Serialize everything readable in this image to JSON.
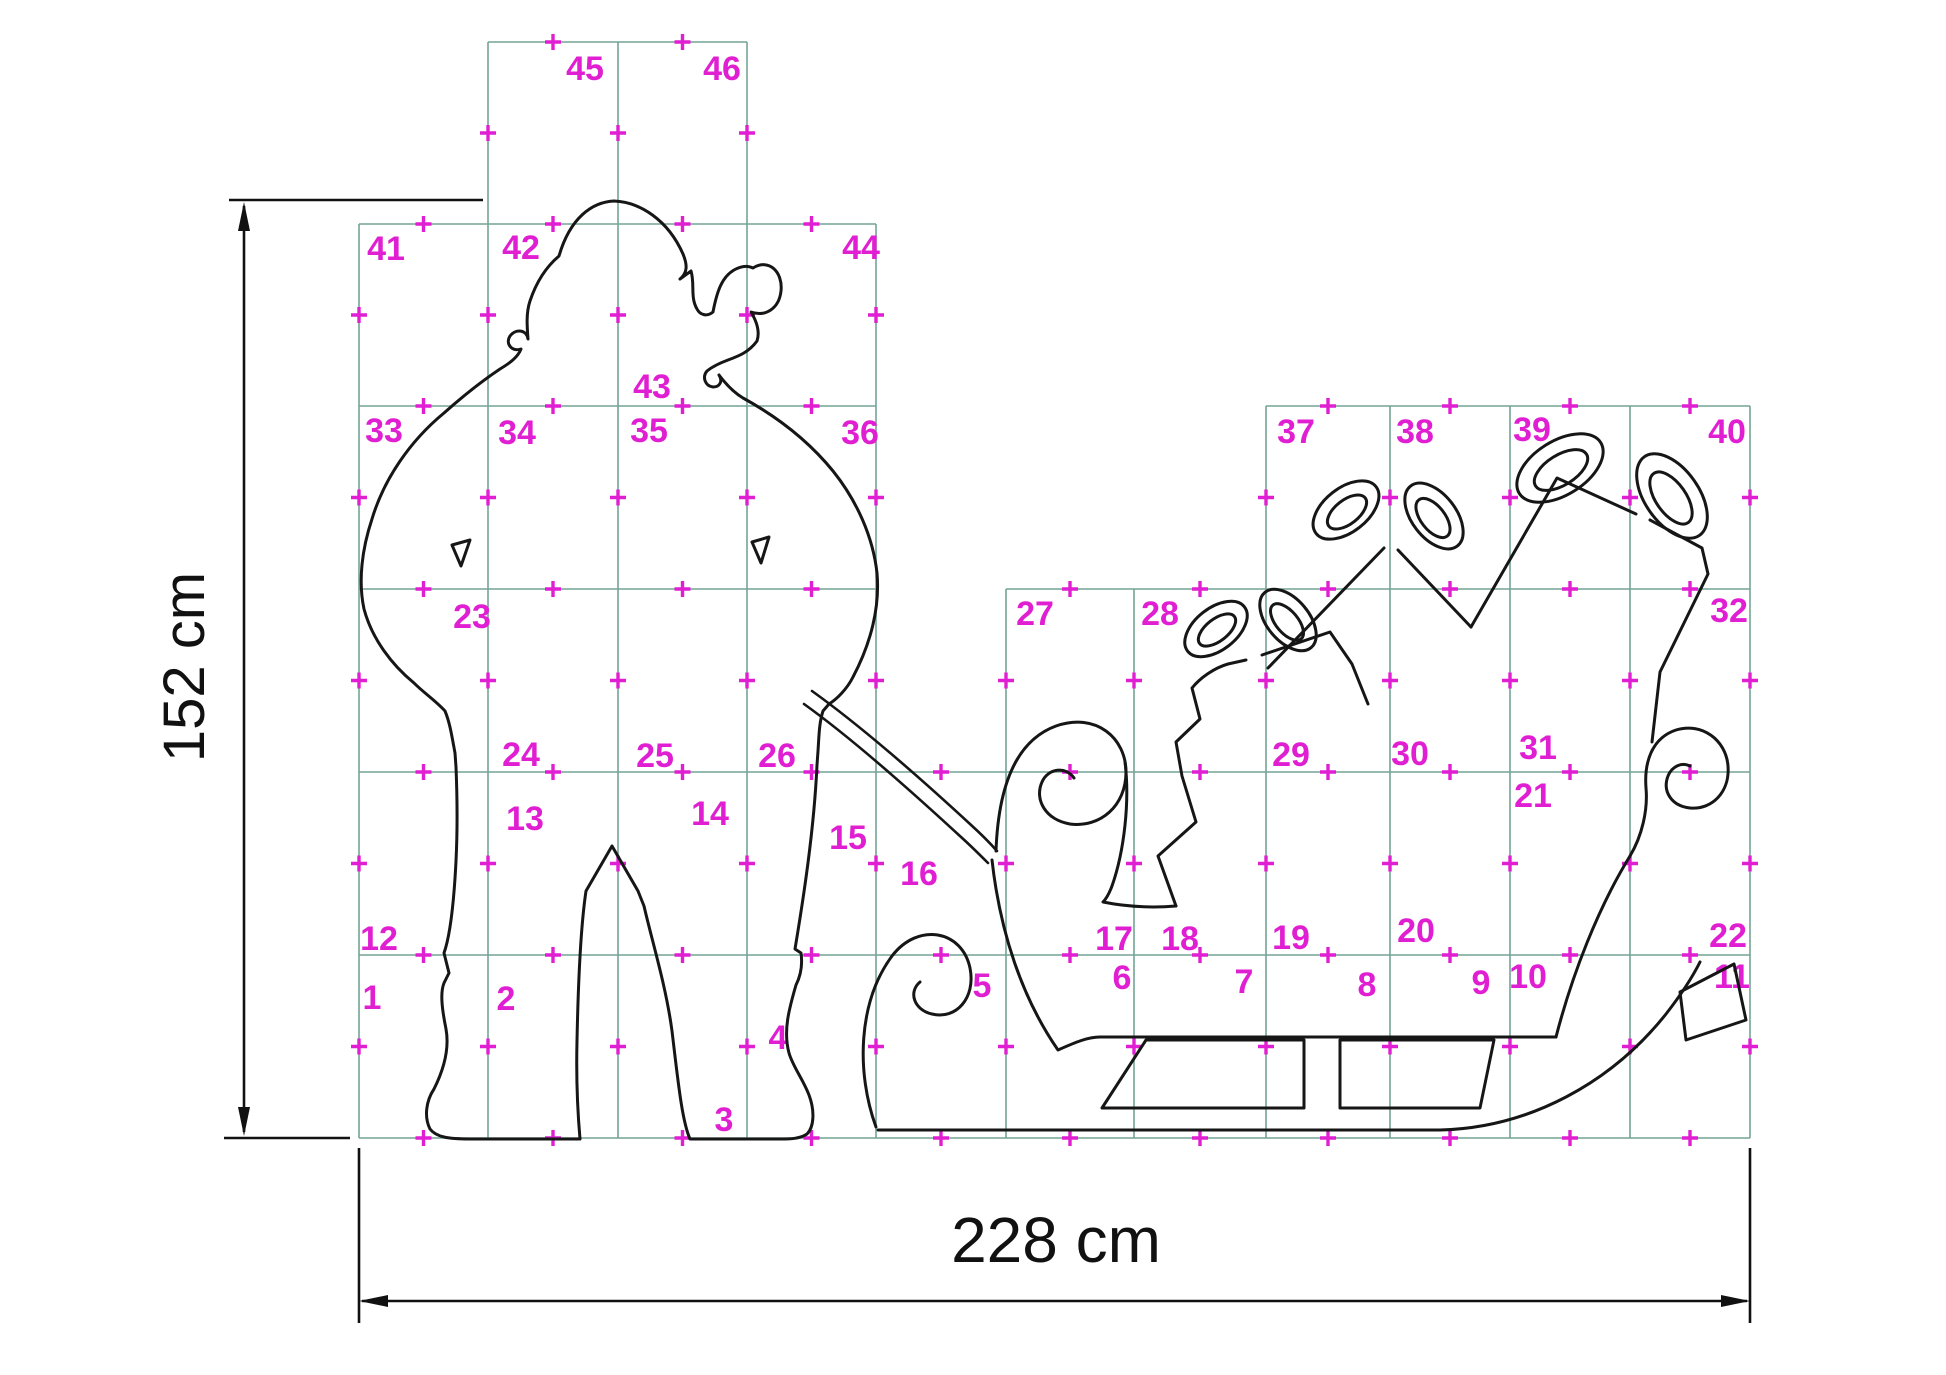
{
  "meta": {
    "description": "Full-size cutting pattern grid sheet: Santa Claus pulling a sleigh loaded with gift boxes, split into numbered tile pages with alignment cross marks and overall dimensions."
  },
  "colors": {
    "background": "#ffffff",
    "grid": "#74a396",
    "mark": "#e01fd2",
    "outline": "#161616",
    "dimension": "#111111"
  },
  "grid": {
    "row_lines": [
      42,
      224,
      406,
      589,
      772,
      955,
      1138
    ],
    "col_lines": [
      359,
      488,
      618,
      747,
      876,
      1006,
      1134,
      1266,
      1390,
      1510,
      1630,
      1750
    ],
    "h_segments": [
      {
        "y": 42,
        "x1": 488,
        "x2": 747
      },
      {
        "y": 224,
        "x1": 359,
        "x2": 876
      },
      {
        "y": 406,
        "x1": 359,
        "x2": 876
      },
      {
        "y": 406,
        "x1": 1266,
        "x2": 1750
      },
      {
        "y": 589,
        "x1": 359,
        "x2": 876
      },
      {
        "y": 589,
        "x1": 1006,
        "x2": 1750
      },
      {
        "y": 772,
        "x1": 359,
        "x2": 1750
      },
      {
        "y": 955,
        "x1": 359,
        "x2": 1750
      },
      {
        "y": 1138,
        "x1": 359,
        "x2": 1750
      }
    ],
    "v_segments": [
      {
        "x": 359,
        "y1": 224,
        "y2": 1138
      },
      {
        "x": 488,
        "y1": 42,
        "y2": 1138
      },
      {
        "x": 618,
        "y1": 42,
        "y2": 1138
      },
      {
        "x": 747,
        "y1": 42,
        "y2": 1138
      },
      {
        "x": 876,
        "y1": 224,
        "y2": 1138
      },
      {
        "x": 1006,
        "y1": 589,
        "y2": 1138
      },
      {
        "x": 1134,
        "y1": 589,
        "y2": 1138
      },
      {
        "x": 1266,
        "y1": 406,
        "y2": 1138
      },
      {
        "x": 1390,
        "y1": 406,
        "y2": 1138
      },
      {
        "x": 1510,
        "y1": 406,
        "y2": 1138
      },
      {
        "x": 1630,
        "y1": 406,
        "y2": 1138
      },
      {
        "x": 1750,
        "y1": 406,
        "y2": 1138
      }
    ],
    "cross_arm": 8
  },
  "cells": [
    {
      "n": "1",
      "x": 372,
      "y": 998
    },
    {
      "n": "2",
      "x": 506,
      "y": 999
    },
    {
      "n": "3",
      "x": 724,
      "y": 1120
    },
    {
      "n": "4",
      "x": 778,
      "y": 1038
    },
    {
      "n": "5",
      "x": 982,
      "y": 986
    },
    {
      "n": "6",
      "x": 1122,
      "y": 978
    },
    {
      "n": "7",
      "x": 1244,
      "y": 982
    },
    {
      "n": "8",
      "x": 1367,
      "y": 985
    },
    {
      "n": "9",
      "x": 1481,
      "y": 983
    },
    {
      "n": "10",
      "x": 1528,
      "y": 977
    },
    {
      "n": "11",
      "x": 1732,
      "y": 977
    },
    {
      "n": "12",
      "x": 379,
      "y": 939
    },
    {
      "n": "13",
      "x": 525,
      "y": 819
    },
    {
      "n": "14",
      "x": 710,
      "y": 814
    },
    {
      "n": "15",
      "x": 848,
      "y": 838
    },
    {
      "n": "16",
      "x": 919,
      "y": 874
    },
    {
      "n": "17",
      "x": 1114,
      "y": 939
    },
    {
      "n": "18",
      "x": 1180,
      "y": 939
    },
    {
      "n": "19",
      "x": 1291,
      "y": 938
    },
    {
      "n": "20",
      "x": 1416,
      "y": 931
    },
    {
      "n": "21",
      "x": 1533,
      "y": 796
    },
    {
      "n": "22",
      "x": 1728,
      "y": 936
    },
    {
      "n": "23",
      "x": 472,
      "y": 617
    },
    {
      "n": "24",
      "x": 521,
      "y": 755
    },
    {
      "n": "25",
      "x": 655,
      "y": 756
    },
    {
      "n": "26",
      "x": 777,
      "y": 756
    },
    {
      "n": "27",
      "x": 1035,
      "y": 614
    },
    {
      "n": "28",
      "x": 1160,
      "y": 614
    },
    {
      "n": "29",
      "x": 1291,
      "y": 755
    },
    {
      "n": "30",
      "x": 1410,
      "y": 754
    },
    {
      "n": "31",
      "x": 1538,
      "y": 748
    },
    {
      "n": "32",
      "x": 1729,
      "y": 611
    },
    {
      "n": "33",
      "x": 384,
      "y": 431
    },
    {
      "n": "34",
      "x": 517,
      "y": 433
    },
    {
      "n": "35",
      "x": 649,
      "y": 431
    },
    {
      "n": "36",
      "x": 860,
      "y": 433
    },
    {
      "n": "37",
      "x": 1296,
      "y": 432
    },
    {
      "n": "38",
      "x": 1415,
      "y": 432
    },
    {
      "n": "39",
      "x": 1532,
      "y": 430
    },
    {
      "n": "40",
      "x": 1727,
      "y": 432
    },
    {
      "n": "41",
      "x": 386,
      "y": 249
    },
    {
      "n": "42",
      "x": 521,
      "y": 248
    },
    {
      "n": "43",
      "x": 652,
      "y": 387
    },
    {
      "n": "44",
      "x": 861,
      "y": 248
    },
    {
      "n": "45",
      "x": 585,
      "y": 69
    },
    {
      "n": "46",
      "x": 722,
      "y": 69
    }
  ],
  "cell_number_font_size": 34,
  "figure": {
    "santa": {
      "body": "M 559 256 C 570 218 592 202 614 201 C 640 202 668 220 683 254 C 688 266 687 273 680 279 L 691 271 C 695 284 690 297 697 309 C 700 315 707 317 713 312 C 717 291 722 277 734 270 C 741 266 747 265 753 268 C 769 258 783 272 781 291 C 779 309 765 317 751 312 C 757 322 760 332 757 341 C 749 352 739 356 728 360 C 720 363 713 366 707 371 C 702 377 705 386 713 387 C 720 387 723 381 719 375 C 725 383 733 392 743 398 C 774 415 807 439 833 471 C 857 501 873 537 877 573 C 880 607 871 643 853 677 C 847 689 837 699 829 704 L 823 711 C 819 723 819 737 818 751 L 817 765 C 814 831 803 901 795 949 L 801 953 C 803 967 800 977 796 985 C 789 1009 783 1031 789 1053 C 793 1067 803 1079 809 1095 C 815 1111 814 1127 807 1134 C 801 1138 793 1139 785 1139 L 690 1139 C 682 1121 678 1081 672 1031 C 666 986 652 941 644 906 L 638 891 L 612 846 L 586 891 C 580 931 578 991 577 1041 C 576 1081 578 1116 580 1139 L 470 1139 C 448 1139 436 1137 430 1129 C 424 1117 426 1101 434 1089 C 442 1073 450 1051 446 1029 C 442 1009 440 993 444 983 L 449 973 L 444 953 C 450 936 454 901 456 861 C 458 821 457 791 456 767 L 455 753 C 452 737 450 723 445 711 C 436 701 424 693 414 683 C 392 665 372 639 364 609 C 358 581 362 549 372 519 C 384 479 410 441 444 413 C 462 397 482 381 500 369 C 510 363 518 357 521 349 C 512 352 505 344 510 336 C 516 328 527 330 528 339 C 527 326 526 313 530 301 C 536 283 546 267 559 256 Z",
      "arm_slits": "M 452 545 L 470 540 L 461 566 Z M 752 542 L 769 537 L 761 563 Z",
      "rope_a": "M 812 691 C 858 724 918 776 970 824 C 981 834 990 843 997 851",
      "rope_b": "M 804 704 C 850 737 909 789 961 837 C 971 846 980 855 988 863"
    },
    "sleigh": {
      "front_curl": "M 996 851 C 998 795 1012 742 1056 726 C 1096 712 1126 738 1126 772 C 1126 806 1100 828 1070 824 C 1046 820 1034 800 1042 782 C 1048 768 1066 766 1074 778",
      "neck_top": "M 1125 762 C 1130 802 1124 852 1112 886 C 1109 894 1106 899 1103 902 C 1128 907 1152 908 1176 906",
      "front_bottom": "M 992 860 C 1000 932 1022 998 1058 1050 C 1076 1042 1088 1037 1100 1037 L 1556 1037",
      "back": "M 1556 1037 C 1572 975 1598 908 1630 856 C 1642 836 1648 810 1646 788 C 1644 762 1652 738 1676 730 C 1702 722 1726 740 1728 766 C 1730 792 1712 810 1690 808 C 1672 806 1662 792 1668 776 C 1672 766 1682 762 1690 766",
      "strut_1": "M 1146 1040 L 1304 1040 L 1304 1108 L 1102 1108 Z",
      "strut_2": "M 1340 1040 L 1494 1040 L 1480 1108 L 1340 1108 Z",
      "runner_spiral": "M 876 1127 C 856 1072 858 1002 892 956 C 918 922 962 930 970 968 C 976 998 956 1020 932 1014 C 914 1010 908 992 920 982",
      "runner_rail": "M 878 1130 L 1440 1130 C 1530 1128 1612 1082 1666 1014 C 1680 996 1692 978 1700 962",
      "runner_tail": "M 1686 1040 L 1680 992 L 1734 964 L 1746 1020 Z"
    },
    "presents": {
      "staircase": "M 1176 906 L 1158 856 L 1196 822 L 1182 776 L 1176 742 L 1200 719 L 1192 688 C 1200 678 1214 668 1228 664 L 1246 660",
      "box_1": "M 1262 655 L 1330 632 L 1352 664 L 1368 704",
      "box_2": "M 1268 668 L 1384 548 M 1398 550 L 1471 627",
      "box_3": "M 1471 627 L 1557 478 L 1636 514 M 1650 520 L 1702 548 L 1708 574 L 1660 672 L 1652 742",
      "bow_loops": [
        {
          "cx": 1216,
          "cy": 629,
          "rx": 36,
          "ry": 21,
          "rot": -38
        },
        {
          "cx": 1217,
          "cy": 630,
          "rx": 22,
          "ry": 11,
          "rot": -38
        },
        {
          "cx": 1288,
          "cy": 620,
          "rx": 36,
          "ry": 21,
          "rot": 50
        },
        {
          "cx": 1287,
          "cy": 622,
          "rx": 22,
          "ry": 11,
          "rot": 50
        },
        {
          "cx": 1346,
          "cy": 510,
          "rx": 38,
          "ry": 22,
          "rot": -38
        },
        {
          "cx": 1347,
          "cy": 512,
          "rx": 23,
          "ry": 12,
          "rot": -38
        },
        {
          "cx": 1434,
          "cy": 516,
          "rx": 38,
          "ry": 22,
          "rot": 52
        },
        {
          "cx": 1433,
          "cy": 518,
          "rx": 23,
          "ry": 12,
          "rot": 52
        },
        {
          "cx": 1560,
          "cy": 468,
          "rx": 48,
          "ry": 27,
          "rot": -32
        },
        {
          "cx": 1561,
          "cy": 470,
          "rx": 30,
          "ry": 15,
          "rot": -32
        },
        {
          "cx": 1672,
          "cy": 496,
          "rx": 48,
          "ry": 27,
          "rot": 55
        },
        {
          "cx": 1671,
          "cy": 498,
          "rx": 30,
          "ry": 15,
          "rot": 55
        }
      ]
    }
  },
  "dimensions": {
    "vertical": {
      "label": "152 cm",
      "line": {
        "x": 244,
        "y1": 206,
        "y2": 1132
      },
      "arrows": [
        "244,202 238,231 250,231",
        "244,1136 238,1107 250,1107"
      ],
      "extensions": [
        {
          "x1": 229,
          "y1": 200,
          "x2": 483,
          "y2": 200
        },
        {
          "x1": 224,
          "y1": 1138,
          "x2": 350,
          "y2": 1138
        }
      ],
      "label_x": 204,
      "label_y": 667,
      "font_size": 58,
      "rotate": -90
    },
    "horizontal": {
      "label": "228 cm",
      "line": {
        "y": 1301,
        "x1": 362,
        "x2": 1747
      },
      "arrows": [
        "359,1301 388,1295 388,1307",
        "1750,1301 1721,1295 1721,1307"
      ],
      "extensions": [
        {
          "x1": 359,
          "y1": 1148,
          "x2": 359,
          "y2": 1323
        },
        {
          "x1": 1750,
          "y1": 1148,
          "x2": 1750,
          "y2": 1323
        }
      ],
      "label_x": 1056,
      "label_y": 1262,
      "font_size": 64,
      "rotate": 0
    }
  }
}
